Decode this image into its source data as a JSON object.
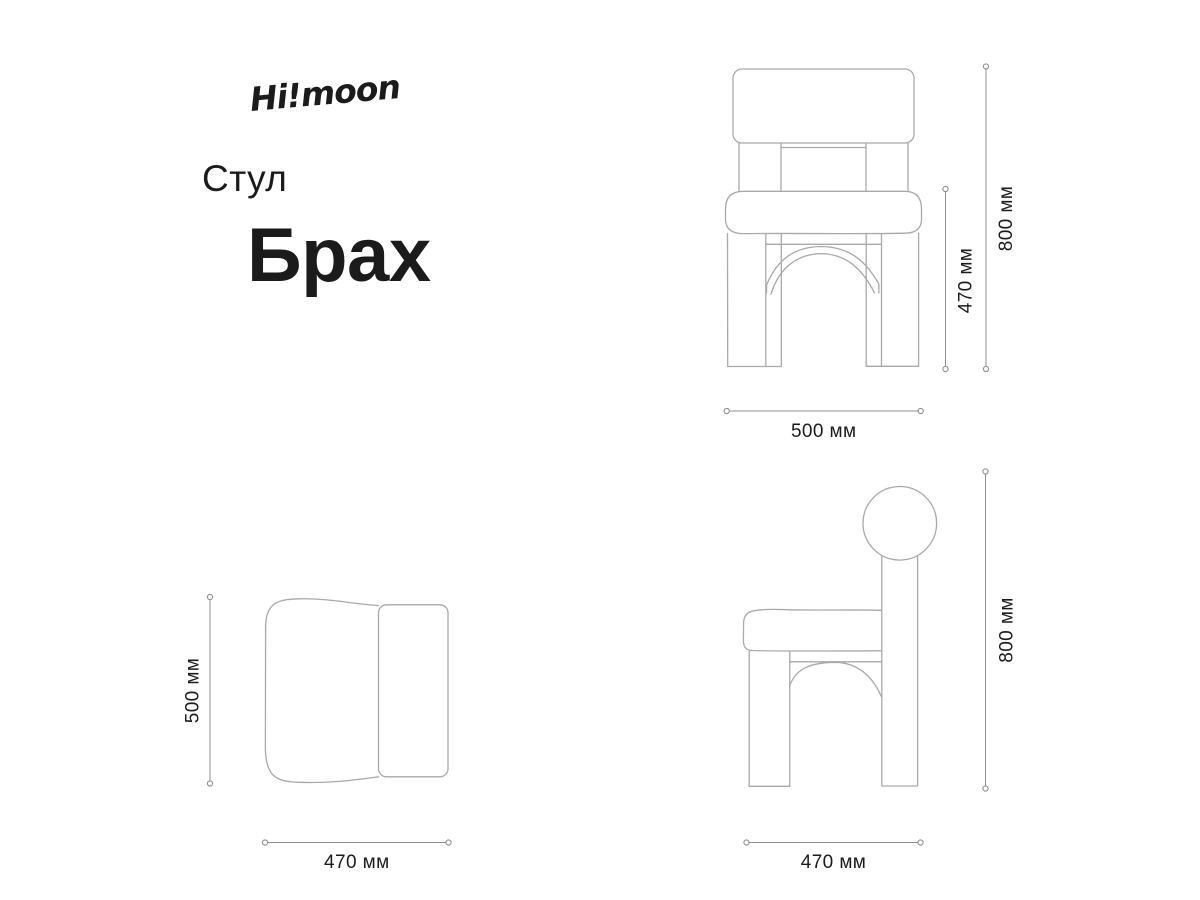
{
  "brand": {
    "logo": "Hi!moon"
  },
  "product": {
    "category": "Стул",
    "name": "Брах"
  },
  "views": {
    "front": {
      "width_label": "500 мм",
      "seat_height_label": "470 мм",
      "height_label": "800 мм"
    },
    "top": {
      "depth_label": "500 мм",
      "width_label": "470 мм"
    },
    "side": {
      "height_label": "800 мм",
      "depth_label": "470 мм"
    }
  },
  "dimensions_mm": {
    "overall_height": 800,
    "seat_height": 470,
    "front_width": 500,
    "seat_depth": 500,
    "seat_width": 470,
    "side_depth": 470
  },
  "colors": {
    "background": "#ffffff",
    "drawing_line": "#a9a9a9",
    "dimension_line": "#8f8f8f",
    "text": "#1b1b1b"
  }
}
